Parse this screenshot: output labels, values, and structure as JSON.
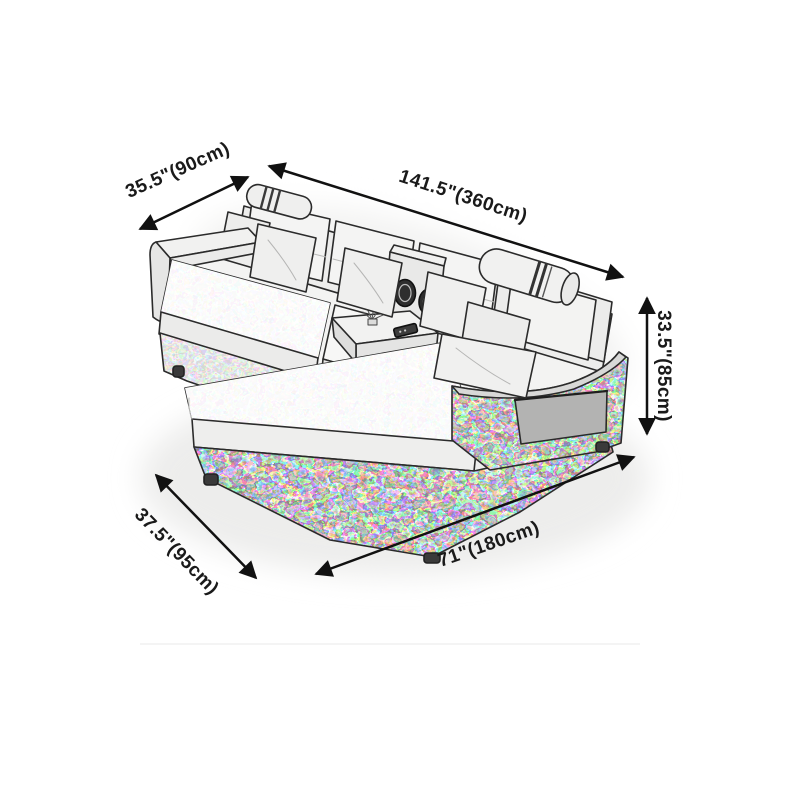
{
  "diagram": {
    "type": "sofa-dimension-diagram",
    "subject": "L-shaped sectional sofa with chaise, pencil sketch",
    "dimensions": [
      {
        "id": "sofa-depth",
        "label": "35.5\"(90cm)"
      },
      {
        "id": "overall-length",
        "label": "141.5\"(360cm)"
      },
      {
        "id": "overall-height",
        "label": "33.5\"(85cm)"
      },
      {
        "id": "chaise-depth",
        "label": "37.5\"(95cm)"
      },
      {
        "id": "chaise-length",
        "label": "71\"(180cm)"
      }
    ],
    "colors": {
      "background": "#ffffff",
      "arrow": "#111111",
      "label_text": "#1a1a1a",
      "sketch_outline": "#2b2b2b",
      "upholstery_light": "#f5f5f4",
      "upholstery_dark_mottle": "#6e6e6e"
    }
  }
}
